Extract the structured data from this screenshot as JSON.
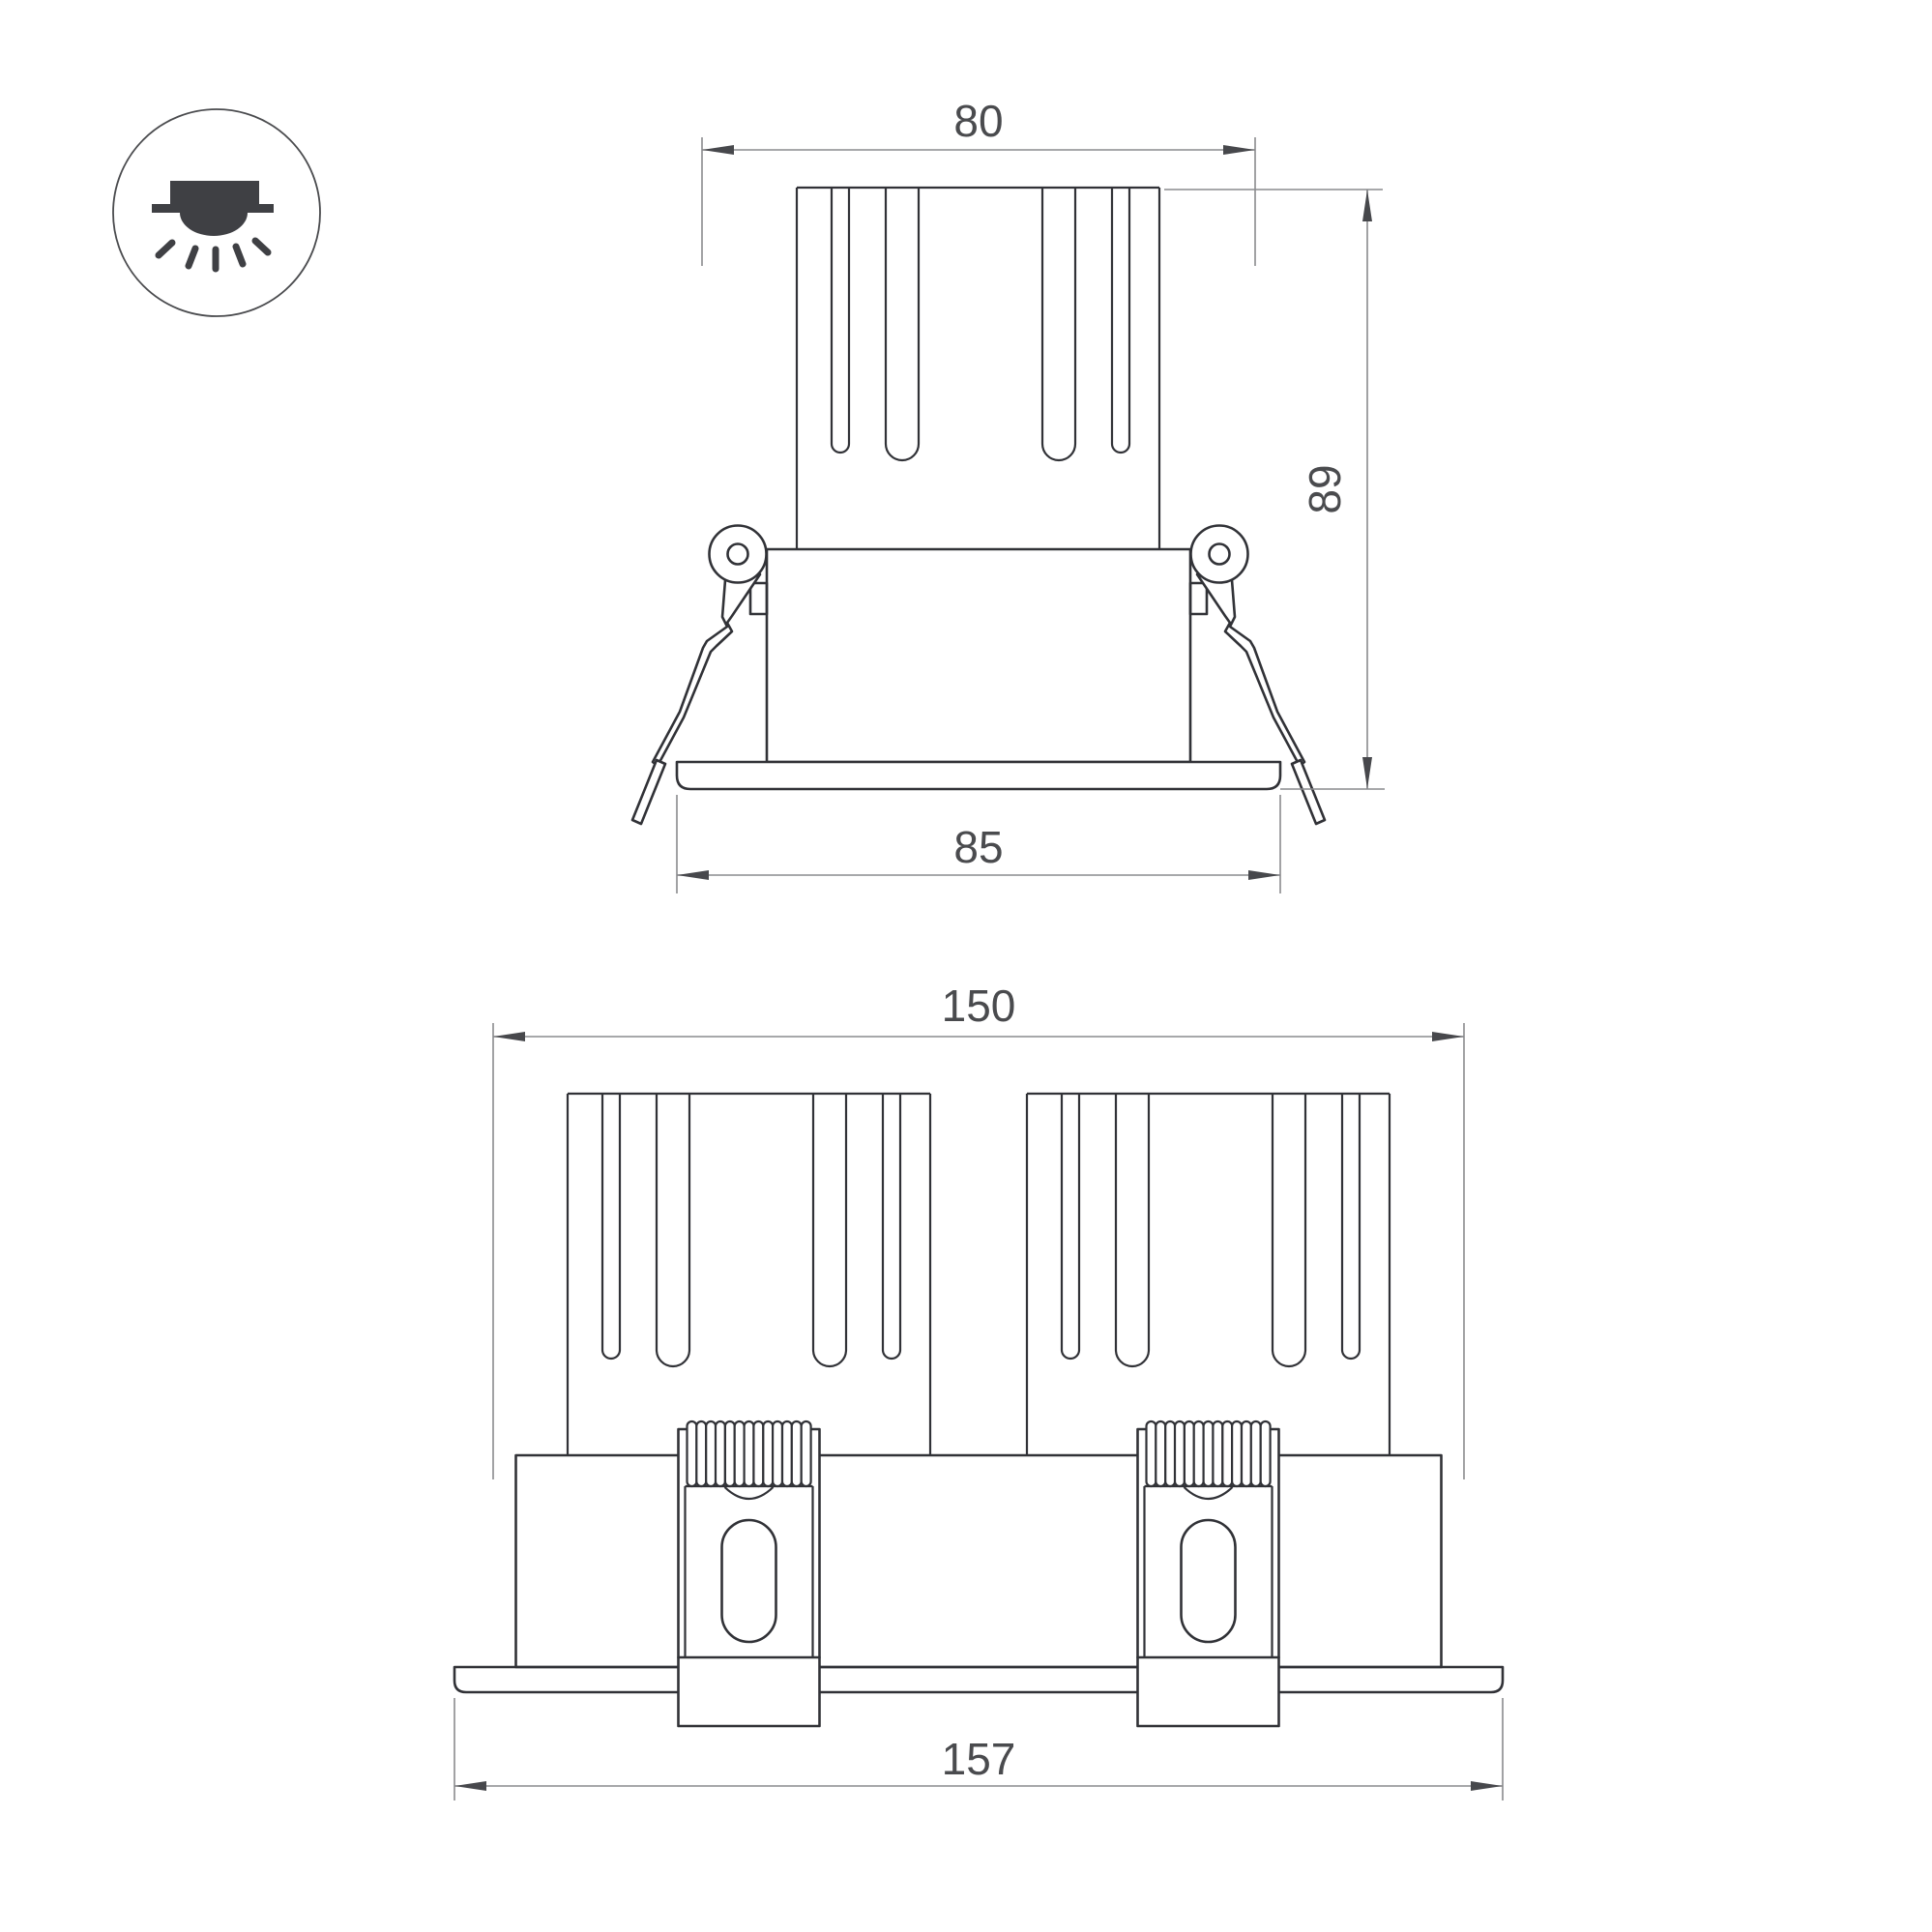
{
  "page": {
    "background": "#ffffff"
  },
  "colors": {
    "object_line": "#313237",
    "dimension_line": "#8a8b8e",
    "arrow": "#47484c",
    "text": "#4a4b4e",
    "icon": "#3f4044"
  },
  "icon": {
    "name": "recessed-downlight-icon"
  },
  "front_view": {
    "dim_width_top": "80",
    "dim_height": "89",
    "dim_width_flange": "85"
  },
  "double_view": {
    "dim_width_body": "150",
    "dim_width_flange": "157"
  }
}
